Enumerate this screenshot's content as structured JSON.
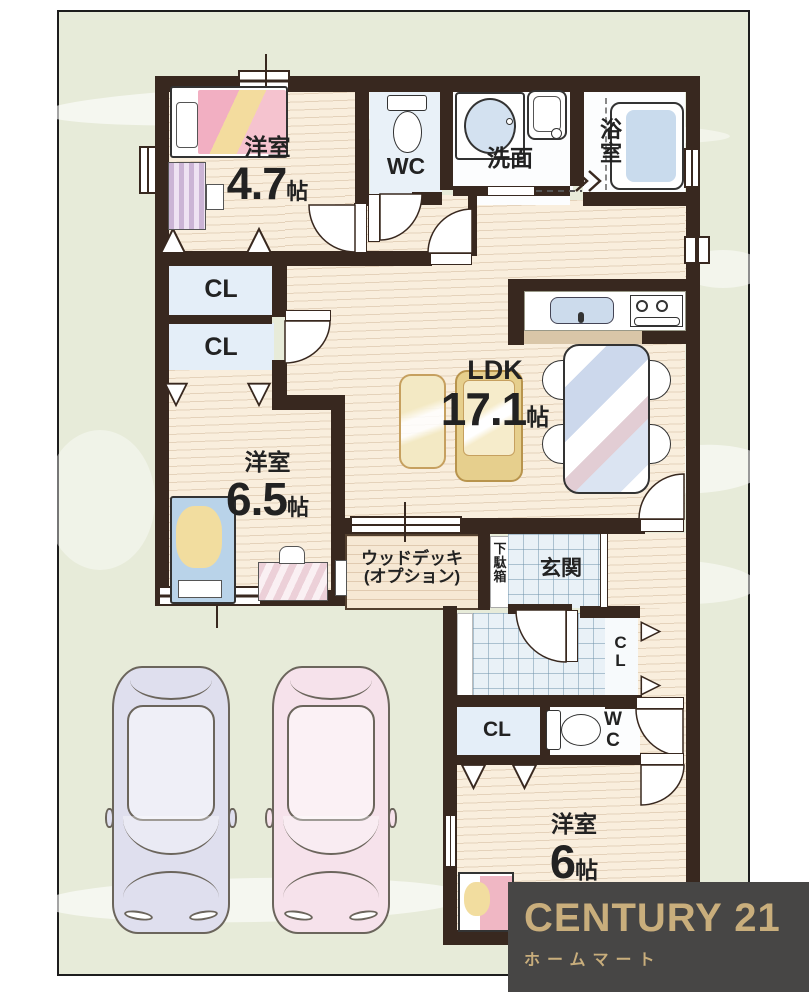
{
  "plan": {
    "rooms": {
      "bedroom47": {
        "name": "洋室",
        "size": "4.7",
        "unit": "帖"
      },
      "toilet_upper": {
        "name": "WC"
      },
      "washroom": {
        "name": "洗面"
      },
      "bathroom": {
        "name": "浴室"
      },
      "closet1": {
        "name": "CL"
      },
      "closet2": {
        "name": "CL"
      },
      "ldk": {
        "name": "LDK",
        "size": "17.1",
        "unit": "帖"
      },
      "bedroom65": {
        "name": "洋室",
        "size": "6.5",
        "unit": "帖"
      },
      "wood_deck": {
        "name": "ウッドデッキ",
        "note": "(オプション)"
      },
      "shoe_cabinet": {
        "name": "下駄箱"
      },
      "entrance": {
        "name": "玄関"
      },
      "closet_hall": {
        "name": "CL"
      },
      "closet3": {
        "name": "CL"
      },
      "toilet_lower": {
        "name": "WC"
      },
      "bedroom6": {
        "name": "洋室",
        "size": "6",
        "unit": "帖"
      }
    },
    "fixtures": {
      "toilet_upper": "toilet-icon",
      "toilet_lower": "toilet-icon",
      "vanity": "vanity-sink-icon",
      "washing_machine": "washing-machine-icon",
      "bathtub": "bathtub-icon",
      "kitchen_sink": "kitchen-sink-icon",
      "gas_stove": "gas-stove-icon",
      "dining_table": "dining-table-icon",
      "dining_chair": "chair-icon",
      "sofa": "sofa-icon",
      "bed": "single-bed-icon",
      "dresser": "dresser-icon",
      "desk": "desk-icon",
      "car": "car-icon",
      "closet_hanger": "hanger-triangle-icon",
      "door": "door-swing-icon",
      "window": "window-icon"
    },
    "colors": {
      "wall": "#38281f",
      "wood_floor": "#f9eedd",
      "tile_floor": "#e9f1f7",
      "closet_fill": "#e4eef8",
      "background_green": "#e7ebd9",
      "car_left": "#dfdfee",
      "car_right": "#f6e2eb"
    }
  },
  "logo": {
    "brand": "CENTURY 21",
    "company": "ホームマート",
    "background": "#474645",
    "gold": "#c9ae7c"
  }
}
